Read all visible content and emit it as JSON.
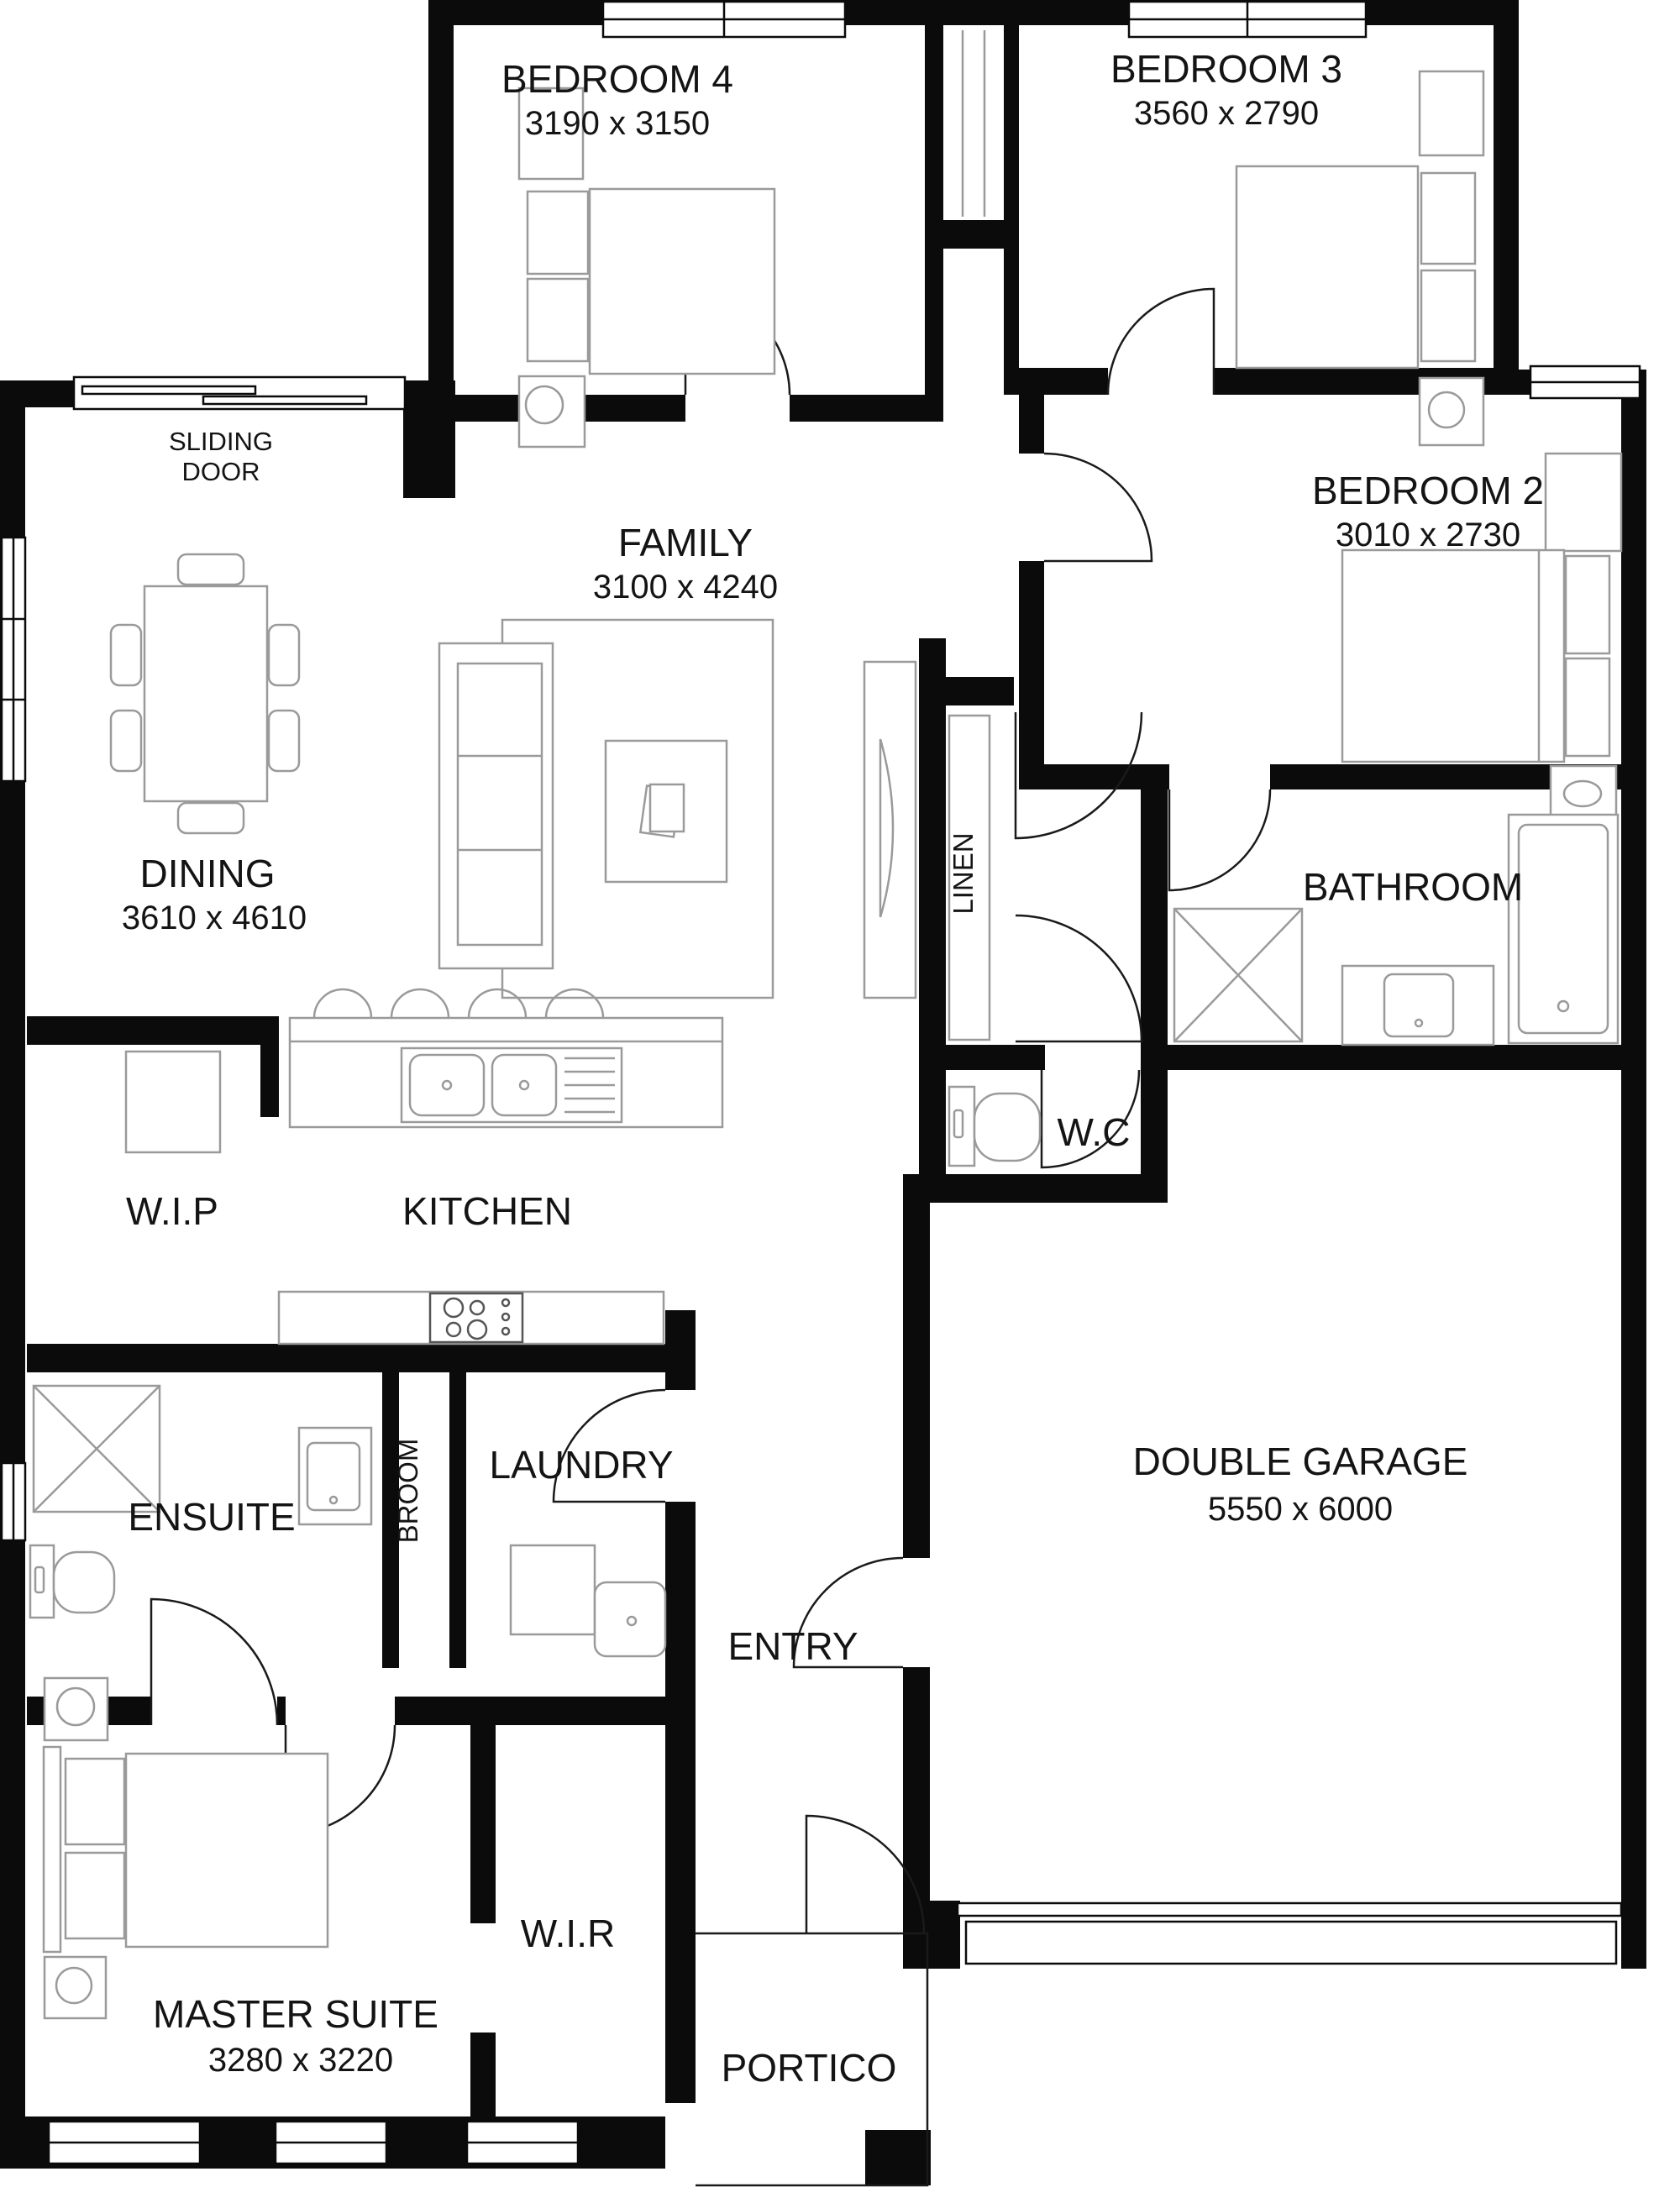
{
  "plan": {
    "rooms": {
      "bedroom4": {
        "name": "BEDROOM 4",
        "dims": "3190 x 3150"
      },
      "bedroom3": {
        "name": "BEDROOM 3",
        "dims": "3560 x 2790"
      },
      "bedroom2": {
        "name": "BEDROOM 2",
        "dims": "3010 x 2730"
      },
      "family": {
        "name": "FAMILY",
        "dims": "3100 x 4240"
      },
      "dining": {
        "name": "DINING",
        "dims": "3610 x 4610"
      },
      "kitchen": {
        "name": "KITCHEN"
      },
      "wip": {
        "name": "W.I.P"
      },
      "linen": {
        "name": "LINEN"
      },
      "wc": {
        "name": "W.C"
      },
      "bathroom": {
        "name": "BATHROOM"
      },
      "ensuite": {
        "name": "ENSUITE"
      },
      "broom": {
        "name": "BROOM"
      },
      "laundry": {
        "name": "LAUNDRY"
      },
      "entry": {
        "name": "ENTRY"
      },
      "garage": {
        "name": "DOUBLE GARAGE",
        "dims": "5550 x 6000"
      },
      "master": {
        "name": "MASTER SUITE",
        "dims": "3280 x 3220"
      },
      "wir": {
        "name": "W.I.R"
      },
      "portico": {
        "name": "PORTICO"
      },
      "sliding_door": {
        "line1": "SLIDING",
        "line2": "DOOR"
      }
    },
    "furniture": {
      "magazine_label": "m"
    },
    "colors": {
      "wall": "#0b0b0b",
      "furniture_outline": "#9a9a9a",
      "text": "#141414",
      "background": "#ffffff"
    }
  }
}
